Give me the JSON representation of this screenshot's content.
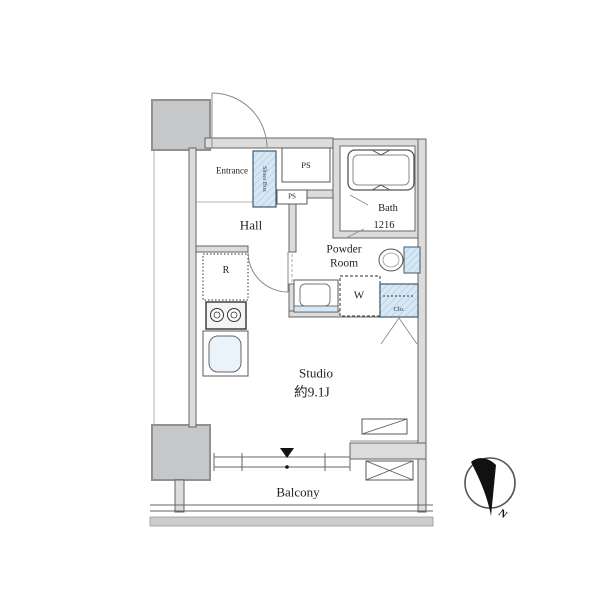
{
  "floorplan": {
    "rooms": {
      "entrance": "Entrance",
      "hall": "Hall",
      "bath": "Bath",
      "bath_size": "1216",
      "powder_room_line1": "Powder",
      "powder_room_line2": "Room",
      "studio": "Studio",
      "studio_area": "約9.1J",
      "balcony": "Balcony"
    },
    "fixtures": {
      "shoes_box": "Shoes Box",
      "ps_upper": "PS",
      "ps_lower": "PS",
      "refrigerator": "R",
      "washer": "W",
      "closet": "Clo."
    },
    "compass": {
      "north": "N"
    },
    "colors": {
      "wall_line": "#646464",
      "wall_fill": "#dcdcdc",
      "pillar_fill": "#c5c7c9",
      "fixture_blue": "#d6e8f4",
      "floor_band": "#cdcdcd",
      "needle_black": "#111111",
      "text": "#222222"
    }
  }
}
